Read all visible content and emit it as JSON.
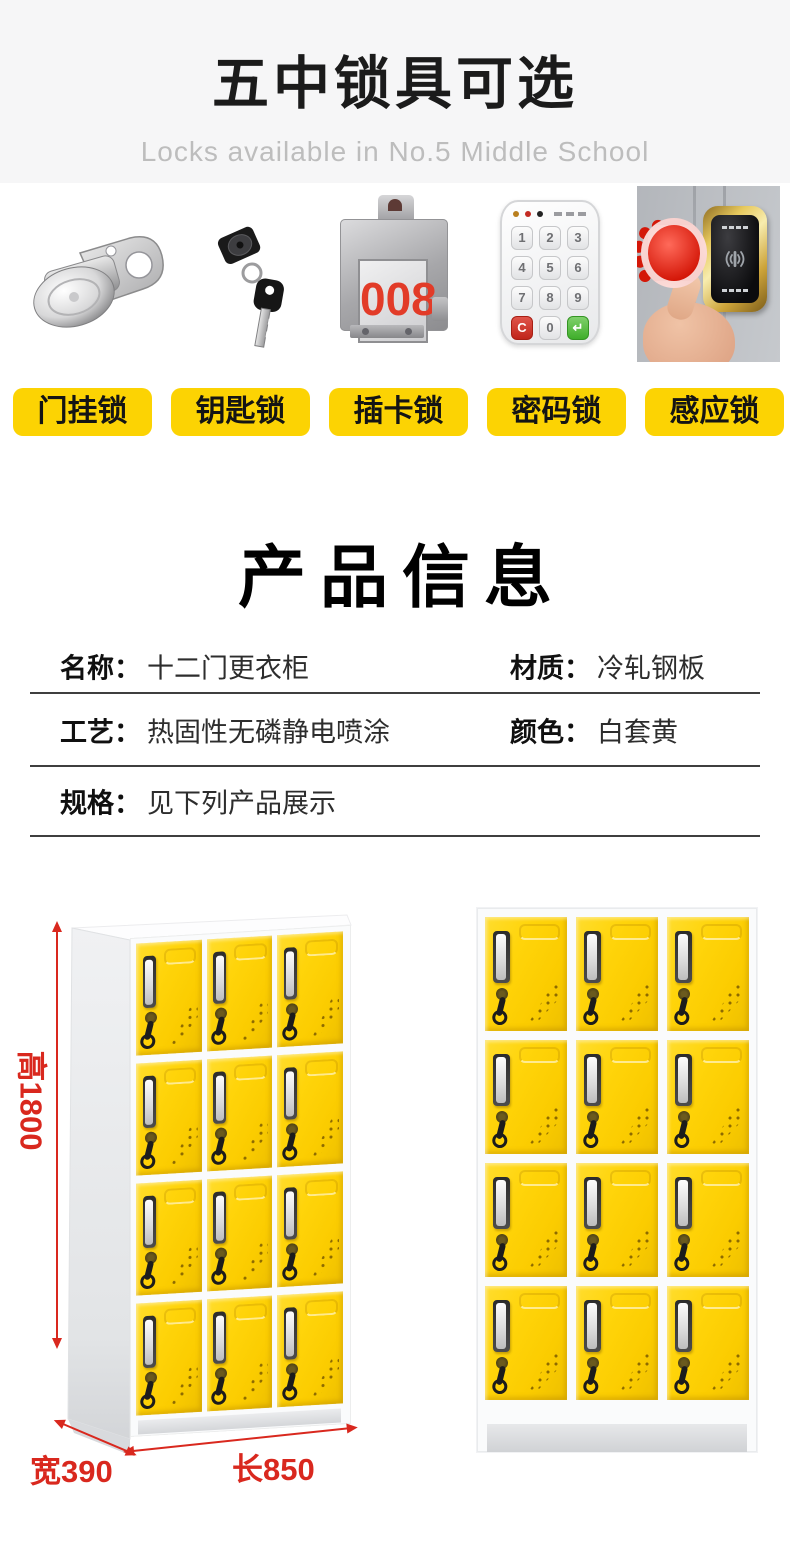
{
  "header": {
    "title": "五中锁具可选",
    "subtitle": "Locks available in No.5 Middle School"
  },
  "locks": {
    "items": [
      {
        "icon": "cam-lock-icon",
        "label": "门挂锁"
      },
      {
        "icon": "key-lock-icon",
        "label": "钥匙锁"
      },
      {
        "icon": "card-lock-icon",
        "label": "插卡锁",
        "display_number": "008"
      },
      {
        "icon": "keypad-lock-icon",
        "label": "密码锁",
        "keys": [
          "1",
          "2",
          "3",
          "4",
          "5",
          "6",
          "7",
          "8",
          "9",
          "C",
          "0",
          "↵"
        ]
      },
      {
        "icon": "rfid-lock-icon",
        "label": "感应锁"
      }
    ]
  },
  "product_info": {
    "title": "产品信息",
    "specs": [
      {
        "label": "名称：",
        "value": "十二门更衣柜"
      },
      {
        "label": "材质：",
        "value": "冷轧钢板"
      },
      {
        "label": "工艺：",
        "value": "热固性无磷静电喷涂"
      },
      {
        "label": "颜色：",
        "value": "白套黄"
      },
      {
        "label": "规格：",
        "value": "见下列产品展示"
      }
    ]
  },
  "lockers": {
    "rows": 4,
    "cols": 3,
    "door_count": 12,
    "dimensions": {
      "height": "高1800",
      "depth": "宽390",
      "length": "长850"
    }
  },
  "colors": {
    "accent_yellow": "#fcd303",
    "door_yellow": "#ffd40a",
    "dimension_red": "#d9281e",
    "header_bg": "#f6f6f7"
  }
}
